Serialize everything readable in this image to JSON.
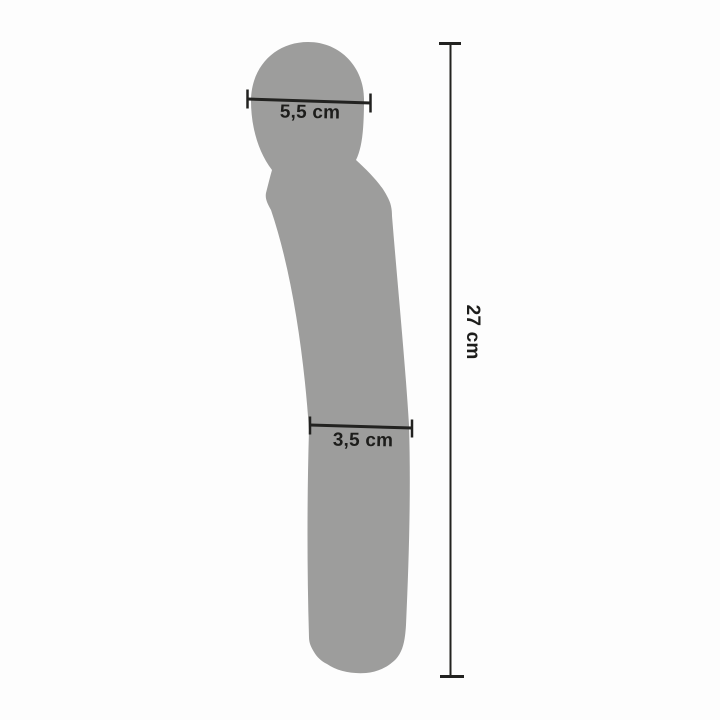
{
  "colors": {
    "background": "#fdfdfd",
    "silhouette": "#9d9d9c",
    "dimension_line": "#222220",
    "label_text": "#1d1d1b"
  },
  "diagram": {
    "measurements": {
      "head_width": {
        "label": "5,5 cm",
        "value": "5,5",
        "unit": "cm"
      },
      "shaft_width": {
        "label": "3,5 cm",
        "value": "3,5",
        "unit": "cm"
      },
      "total_length": {
        "label": "27 cm",
        "value": "27",
        "unit": "cm"
      }
    }
  }
}
